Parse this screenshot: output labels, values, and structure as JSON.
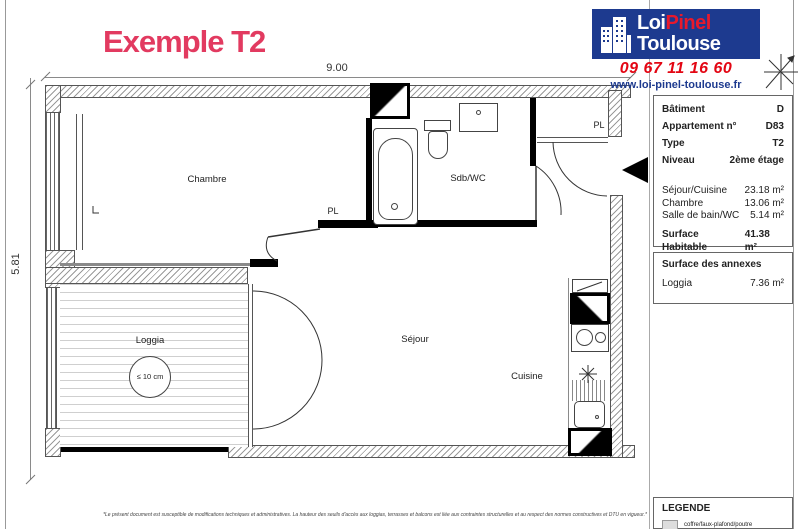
{
  "title": "Exemple T2",
  "dimensions": {
    "width_label": "9.00",
    "height_label": "5.81"
  },
  "plan": {
    "labels": {
      "chambre": "Chambre",
      "sdb": "Sdb/WC",
      "sejour": "Séjour",
      "cuisine": "Cuisine",
      "loggia": "Loggia",
      "pl_chambre": "PL",
      "pl_entree": "PL",
      "loggia_note": "≤ 10 cm"
    }
  },
  "branding": {
    "logo_word1": "Loi",
    "logo_word2": "Pinel",
    "logo_word3": "Toulouse",
    "phone": "09 67 11 16 60",
    "website": "www.loi-pinel-toulouse.fr",
    "colors": {
      "navy": "#1d3a8f",
      "red": "#e30613",
      "title_pink": "#e23a60"
    }
  },
  "icons": [
    "building-icon",
    "compass-icon",
    "entrance-arrow-icon",
    "duct-symbol",
    "extractor-symbol",
    "coffre-swatch"
  ],
  "info": {
    "rows": [
      {
        "label": "Bâtiment",
        "value": "D"
      },
      {
        "label": "Appartement n°",
        "value": "D83"
      },
      {
        "label": "Type",
        "value": "T2"
      },
      {
        "label": "Niveau",
        "value": "2ème étage"
      }
    ],
    "surfaces": [
      {
        "label": "Séjour/Cuisine",
        "value": "23.18 m²"
      },
      {
        "label": "Chambre",
        "value": "13.06 m²"
      },
      {
        "label": "Salle de bain/WC",
        "value": "5.14 m²"
      }
    ],
    "total": {
      "label": "Surface Habitable",
      "value": "41.38 m²"
    },
    "total_note": "La surface des pièces comprend la surface des placards",
    "annexes": {
      "header": "Surface des annexes",
      "rows": [
        {
          "label": "Loggia",
          "value": "7.36 m²"
        }
      ]
    }
  },
  "legend": {
    "header": "LEGENDE",
    "items": [
      {
        "label": "coffre/faux-plafond/poutre"
      }
    ]
  },
  "footer": {
    "disclaimer": "*Le présent document est susceptible de modifications techniques et administratives. La hauteur des seuils d'accès aux loggias, terrasses et balcons est liée aux contraintes structurelles et au respect des normes constructives et DTU en vigueur.*"
  }
}
